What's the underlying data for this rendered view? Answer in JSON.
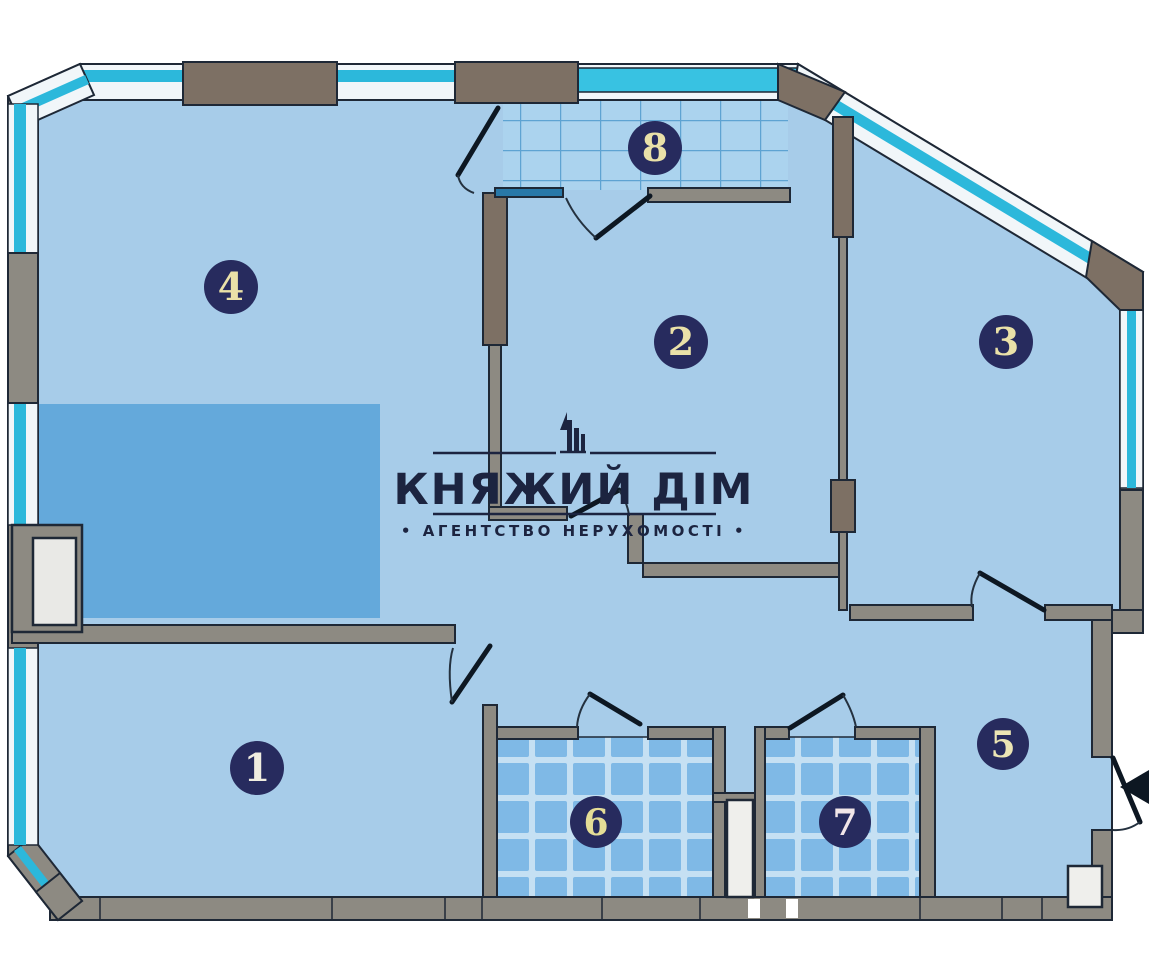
{
  "watermark": {
    "brand": "КНЯЖИЙ ДІМ",
    "tagline": "• АГЕНТСТВО  НЕРУХОМОСТІ •",
    "logo_icon": "building-skyline-icon"
  },
  "floor_plan": {
    "rooms": [
      {
        "id": "room-1",
        "number": "1"
      },
      {
        "id": "room-2",
        "number": "2"
      },
      {
        "id": "room-3",
        "number": "3"
      },
      {
        "id": "room-4",
        "number": "4"
      },
      {
        "id": "room-5",
        "number": "5"
      },
      {
        "id": "room-6",
        "number": "6"
      },
      {
        "id": "room-7",
        "number": "7"
      },
      {
        "id": "room-8",
        "number": "8"
      }
    ],
    "entrance_icon": "entrance-arrow-icon"
  },
  "colors": {
    "floor": "#a7cce9",
    "accent_zone": "#64a9db",
    "wall_gray": "#8d8a82",
    "pier_brown": "#7d7064",
    "outline_dark": "#1e2836",
    "door_black": "#0d1722",
    "window_cyan": "#2cb8db",
    "balcony_glass": "#38c2e2",
    "window_white": "#f1f6f9",
    "tile_balcony_base": "#abd3ee",
    "tile_balcony_line": "#5ea3d2",
    "tile_wet_grout": "#c5e0f3",
    "tile_wet_tile": "#7fb9e6",
    "badge_fill": "#272b5e",
    "badge_text": "#eae1a8",
    "logo_ink": "#1c2440"
  }
}
